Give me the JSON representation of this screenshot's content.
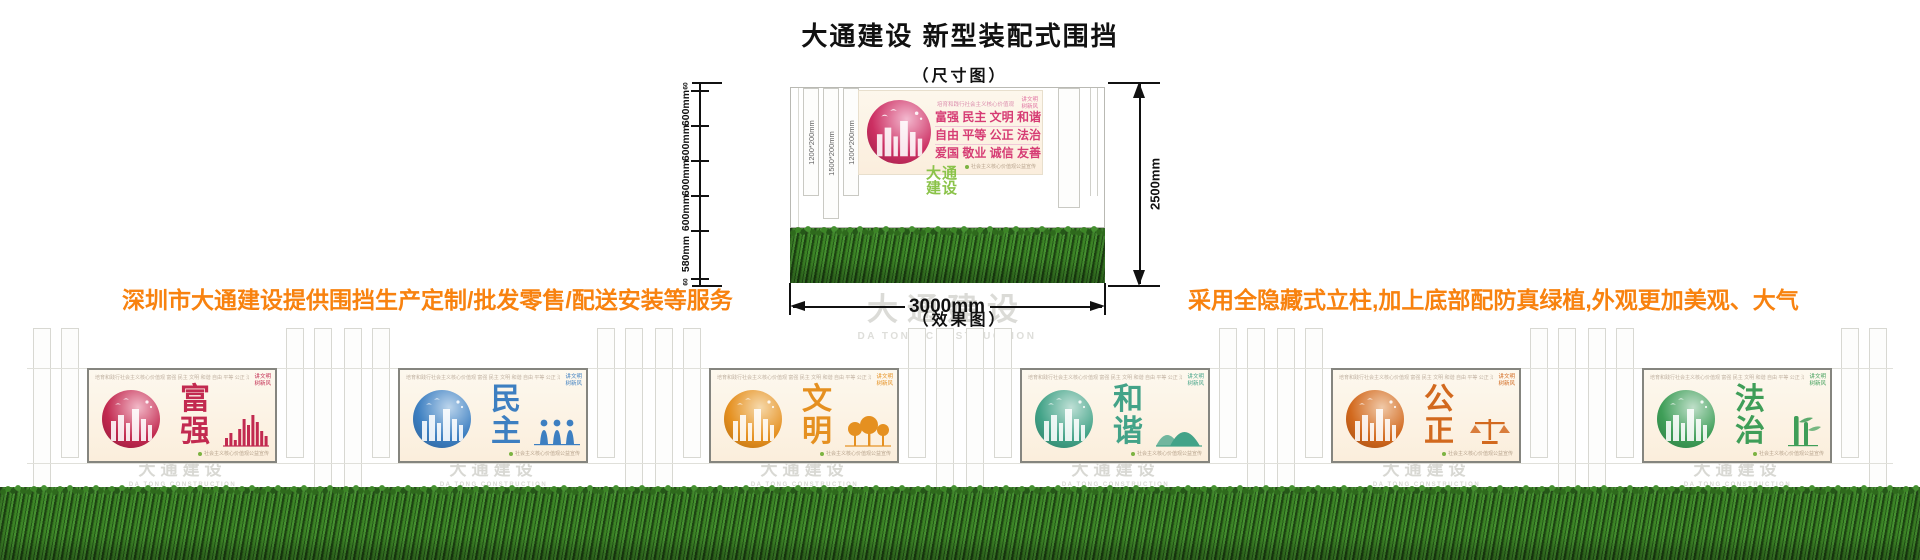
{
  "header": {
    "title": "大通建设 新型装配式围挡",
    "size_label": "（尺寸图）",
    "effect_label": "（效果图）"
  },
  "notes": {
    "left": "深圳市大通建设提供围挡生产定制/批发零售/配送安装等服务",
    "right": "采用全隐藏式立柱,加上底部配防真绿植,外观更加美观、大气",
    "color": "#f8820f"
  },
  "diagram": {
    "left_ruler": [
      "60",
      "600mm",
      "600mm",
      "600mm",
      "600mm",
      "580mm",
      "60"
    ],
    "strip_labels": [
      "1200*200mm",
      "1500*200mm",
      "1200*200mm"
    ],
    "right_dim": "2500mm",
    "bottom_dim": "3000mm",
    "logo_line1": "大通",
    "logo_line2": "建设",
    "poster": {
      "header": "培育和践行社会主义核心价值观",
      "corner1": "讲文明",
      "corner2": "树新风",
      "rows": [
        "富强 民主 文明 和谐",
        "自由 平等 公正 法治",
        "爱国 敬业 诚信 友善"
      ],
      "footer": "社会主义核心价值观公益宣传",
      "colors": {
        "main": "#d63c74",
        "circle": "#cc2f62",
        "circle_light": "#f3b9cf",
        "circle_dark": "#971c44"
      }
    }
  },
  "watermark": {
    "cn": "大通建设",
    "en": "DA TONG CONSTRUCTION"
  },
  "panel_common": {
    "header": "培育和践行社会主义核心价值观",
    "values_row": "富强 民主 文明 和谐 自由 平等 公正 法治 爱国 敬业 诚信 友善",
    "corner1": "讲文明",
    "corner2": "树新风",
    "footer": "社会主义核心价值观公益宣传"
  },
  "panels": [
    {
      "word": "富强",
      "color": "#c22a50",
      "light": "#f2b9c8",
      "dark": "#8f1638",
      "decor": "bars"
    },
    {
      "word": "民主",
      "color": "#3d7fc1",
      "light": "#bcd5ec",
      "dark": "#2a5d94",
      "decor": "figures"
    },
    {
      "word": "文明",
      "color": "#e59020",
      "light": "#f6d9ab",
      "dark": "#b26a0e",
      "decor": "trees"
    },
    {
      "word": "和谐",
      "color": "#43a388",
      "light": "#bfe0d6",
      "dark": "#2b7a63",
      "decor": "hills"
    },
    {
      "word": "公正",
      "color": "#d2691e",
      "light": "#f0c9a8",
      "dark": "#9e4a10",
      "decor": "scales"
    },
    {
      "word": "法治",
      "color": "#3f9e58",
      "light": "#bfdfc9",
      "dark": "#2a7a40",
      "decor": "bamboo"
    }
  ]
}
